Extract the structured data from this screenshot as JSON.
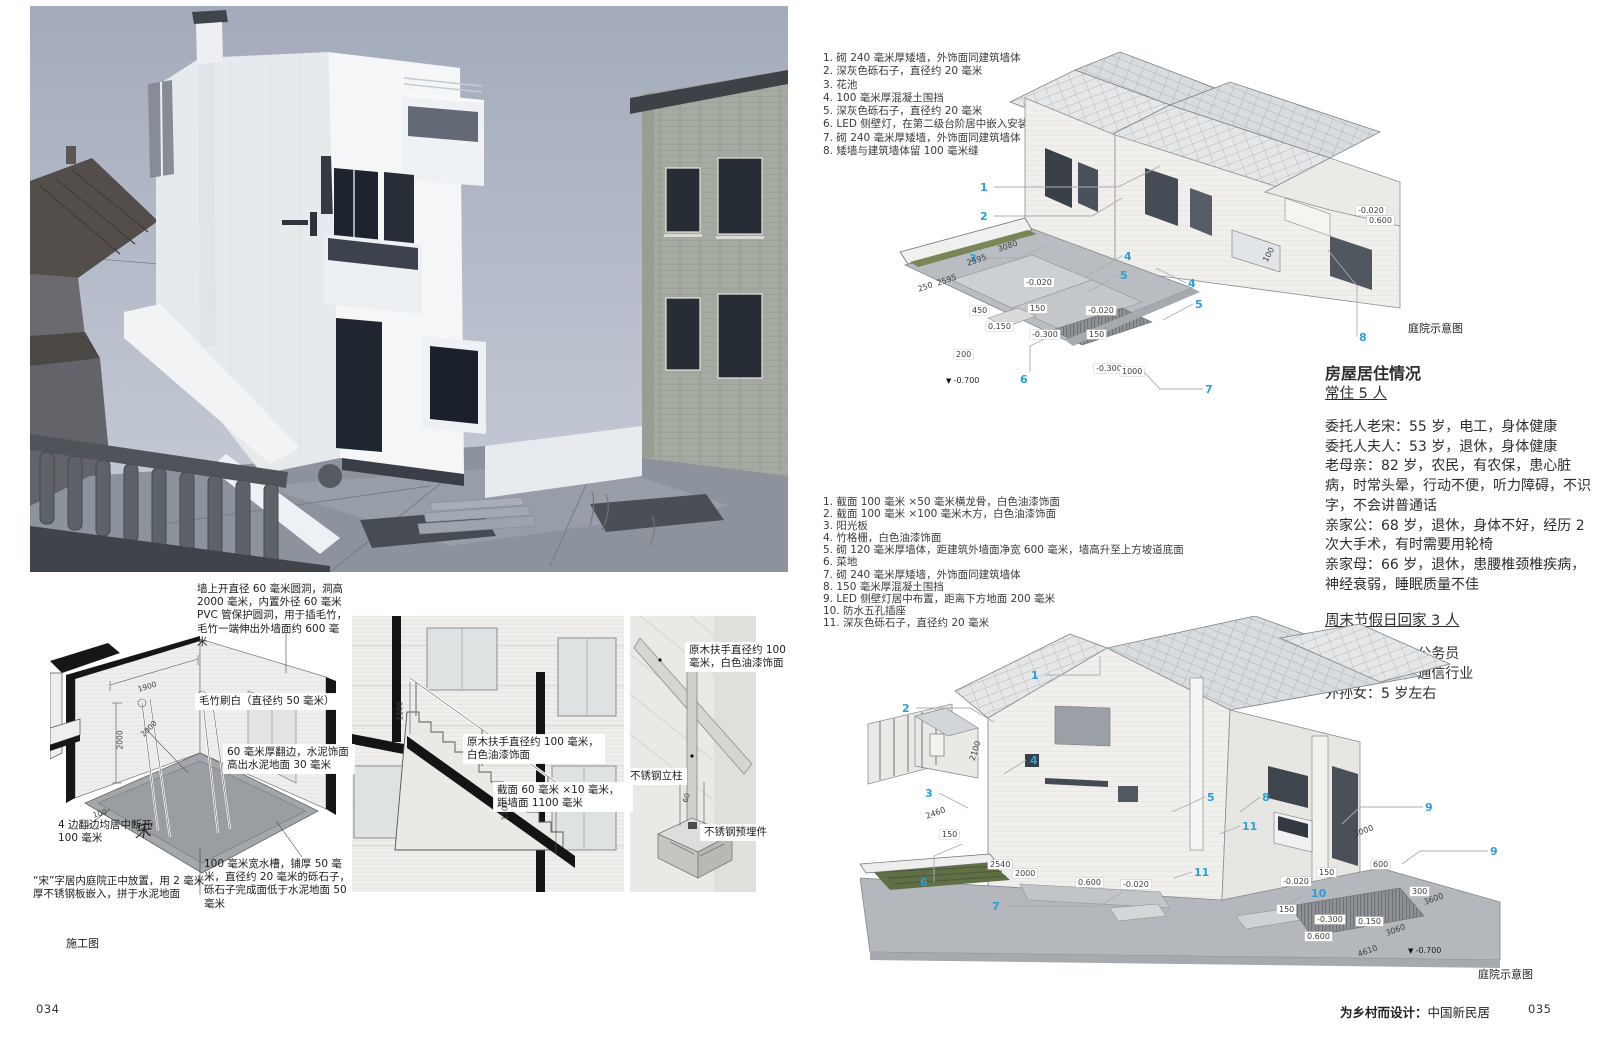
{
  "colors": {
    "callout_blue": "#2b9fd9",
    "accent_green": "#7a8657"
  },
  "meta": {
    "page_left_number": "034",
    "page_right_number": "035",
    "footer_title_bold": "为乡村而设计：",
    "footer_title_regular": "中国新民居"
  },
  "left_page": {
    "construction_caption": "施工图",
    "diagram_courtyard": {
      "note_top": "墙上开直径 60 毫米圆洞，洞高 2000 毫米，内置外径 60 毫米 PVC 管保护圆洞，用于插毛竹，毛竹一端伸出外墙面约 600 毫米",
      "label_bamboo": "毛竹刷白（直径约 50 毫米）",
      "label_edge": "60 毫米厚翻边，水泥饰面高出水泥地面 30 毫米",
      "label_gap": "4 边翻边均居中断开 100 毫米",
      "label_song": "“宋”字居内庭院正中放置，用 2 毫米厚不锈钢板嵌入，拼于水泥地面",
      "label_trough": "100 毫米宽水槽，铺厚 50 毫米，直径约 20 毫米的砾石子，砾石子完成面低于水泥地面 50 毫米",
      "floor_character": "宋",
      "dims": [
        {
          "t": "1900",
          "x": 88,
          "y": 52,
          "r": -17
        },
        {
          "t": "2000",
          "x": 70,
          "y": 112,
          "r": -90
        },
        {
          "t": "2000",
          "x": 92,
          "y": 98,
          "r": -45
        },
        {
          "t": "100",
          "x": 43,
          "y": 178,
          "r": -17
        }
      ]
    },
    "diagram_stairs": {
      "label_handrail": "原木扶手直径约 100 毫米，白色油漆饰面",
      "label_section": "截面 60 毫米 ×10 毫米，距墙面 1100 毫米",
      "dims": [
        {
          "t": "1100",
          "x": 48,
          "y": 100,
          "r": -90
        },
        {
          "t": "1100",
          "x": 153,
          "y": 200,
          "r": -90
        }
      ]
    },
    "diagram_post": {
      "label_handrail": "原木扶手直径约 100 毫米，白色油漆饰面",
      "label_post": "不锈钢立柱",
      "label_embed": "不锈钢预埋件",
      "dims": [
        {
          "t": "60",
          "x": 55,
          "y": 182,
          "r": -75
        }
      ]
    }
  },
  "right_page": {
    "notes_upper": [
      "1.  砌 240 毫米厚矮墙，外饰面同建筑墙体",
      "2.  深灰色砾石子，直径约 20 毫米",
      "3.  花池",
      "4.  100 毫米厚混凝土围挡",
      "5.  深灰色砾石子，直径约 20 毫米",
      "6.  LED 侧壁灯，在第二级台阶居中嵌入安装",
      "7.  砌 240 毫米厚矮墙，外饰面同建筑墙体",
      "8.  矮墙与建筑墙体留 100 毫米缝"
    ],
    "notes_lower": [
      "1.  截面 100 毫米 ×50 毫米横龙骨，白色油漆饰面",
      "2.  截面 100 毫米 ×100 毫米木方，白色油漆饰面",
      "3.  阳光板",
      "4.  竹格栅，白色油漆饰面",
      "5.  砌 120 毫米厚墙体，距建筑外墙面净宽 600 毫米，墙高升至上方坡道底面",
      "6.  菜地",
      "7.  砌 240 毫米厚矮墙，外饰面同建筑墙体",
      "8.  150 毫米厚混凝土围挡",
      "9.  LED 侧壁灯居中布置，距离下方地面 200 毫米",
      "10. 防水五孔插座",
      "11. 深灰色砾石子，直径约 20 毫米"
    ],
    "occupancy": {
      "title": "房屋居住情况",
      "subhead_resident": "常住 5 人",
      "residents": [
        "委托人老宋：55 岁，电工，身体健康",
        "委托人夫人：53 岁，退休，身体健康",
        "老母亲：82 岁，农民，有农保，患心脏病，时常头晕，行动不便，听力障碍，不识字，不会讲普通话",
        "亲家公：68 岁，退休，身体不好，经历 2 次大手术，有时需要用轮椅",
        "亲家母：66 岁，退休，患腰椎颈椎疾病，神经衰弱，睡眠质量不佳"
      ],
      "subhead_weekend": "周末节假日回家 3 人",
      "weekend": [
        "女儿：31 岁，公务员",
        "女婿：36 岁，通信行业",
        "外孙女：5 岁左右"
      ]
    },
    "axon_upper": {
      "caption": "庭院示意图",
      "callouts": [
        {
          "t": "1",
          "x": 120,
          "y": 141
        },
        {
          "t": "2",
          "x": 120,
          "y": 170
        },
        {
          "t": "3",
          "x": 109,
          "y": 212
        },
        {
          "t": "4",
          "x": 264,
          "y": 210
        },
        {
          "t": "5",
          "x": 260,
          "y": 229
        },
        {
          "t": "4",
          "x": 328,
          "y": 237
        },
        {
          "t": "5",
          "x": 335,
          "y": 258
        },
        {
          "t": "6",
          "x": 160,
          "y": 333
        },
        {
          "t": "7",
          "x": 345,
          "y": 343
        },
        {
          "t": "8",
          "x": 499,
          "y": 291
        }
      ],
      "dims": [
        {
          "t": "3080",
          "x": 138,
          "y": 205,
          "r": -19,
          "k": "rot"
        },
        {
          "t": "2595",
          "x": 107,
          "y": 219,
          "r": -19,
          "k": "rot"
        },
        {
          "t": "2595",
          "x": 77,
          "y": 239,
          "r": -19,
          "k": "rot"
        },
        {
          "t": "250",
          "x": 58,
          "y": 245,
          "r": -19,
          "k": "rot"
        },
        {
          "t": "100",
          "x": 405,
          "y": 217,
          "r": -62,
          "k": "rot"
        },
        {
          "t": "-0.020",
          "x": 164,
          "y": 238,
          "k": "box"
        },
        {
          "t": "450",
          "x": 110,
          "y": 266,
          "k": "box"
        },
        {
          "t": "150",
          "x": 168,
          "y": 264,
          "k": "box"
        },
        {
          "t": "0.150",
          "x": 126,
          "y": 282,
          "k": "box"
        },
        {
          "t": "-0.300",
          "x": 170,
          "y": 290,
          "k": "box"
        },
        {
          "t": "-0.020",
          "x": 226,
          "y": 266,
          "k": "box"
        },
        {
          "t": "150",
          "x": 227,
          "y": 290,
          "k": "box"
        },
        {
          "t": "-0.300",
          "x": 234,
          "y": 324,
          "k": "box"
        },
        {
          "t": "1000",
          "x": 260,
          "y": 327,
          "k": "box"
        },
        {
          "t": "200",
          "x": 94,
          "y": 310,
          "k": "box"
        },
        {
          "t": "-0.020",
          "x": 496,
          "y": 166,
          "k": "box"
        },
        {
          "t": "0.600",
          "x": 507,
          "y": 176,
          "k": "box"
        },
        {
          "t": "-0.700",
          "x": 86,
          "y": 336,
          "k": "lvl"
        }
      ]
    },
    "axon_lower": {
      "caption": "庭院示意图",
      "callouts": [
        {
          "t": "1",
          "x": 171,
          "y": 53
        },
        {
          "t": "2",
          "x": 42,
          "y": 86
        },
        {
          "t": "3",
          "x": 65,
          "y": 171
        },
        {
          "t": "4",
          "x": 170,
          "y": 138
        },
        {
          "t": "5",
          "x": 347,
          "y": 175
        },
        {
          "t": "6",
          "x": 60,
          "y": 260
        },
        {
          "t": "7",
          "x": 132,
          "y": 284
        },
        {
          "t": "8",
          "x": 402,
          "y": 175
        },
        {
          "t": "9",
          "x": 565,
          "y": 185
        },
        {
          "t": "9",
          "x": 630,
          "y": 229
        },
        {
          "t": "10",
          "x": 451,
          "y": 271
        },
        {
          "t": "11",
          "x": 382,
          "y": 204
        },
        {
          "t": "11",
          "x": 334,
          "y": 250
        }
      ],
      "dims": [
        {
          "t": "2100",
          "x": 112,
          "y": 140,
          "r": -72,
          "k": "rot"
        },
        {
          "t": "2460",
          "x": 66,
          "y": 196,
          "r": -20,
          "k": "rot"
        },
        {
          "t": "3000",
          "x": 494,
          "y": 214,
          "r": -20,
          "k": "rot"
        },
        {
          "t": "3600",
          "x": 564,
          "y": 282,
          "r": -20,
          "k": "rot"
        },
        {
          "t": "3060",
          "x": 526,
          "y": 313,
          "r": -20,
          "k": "rot"
        },
        {
          "t": "4610",
          "x": 498,
          "y": 334,
          "r": -20,
          "k": "rot"
        },
        {
          "t": "150",
          "x": 80,
          "y": 214,
          "k": "box"
        },
        {
          "t": "2540",
          "x": 128,
          "y": 244,
          "k": "box"
        },
        {
          "t": "2000",
          "x": 153,
          "y": 253,
          "k": "box"
        },
        {
          "t": "0.600",
          "x": 216,
          "y": 262,
          "k": "box"
        },
        {
          "t": "-0.020",
          "x": 261,
          "y": 264,
          "k": "box"
        },
        {
          "t": "600",
          "x": 511,
          "y": 244,
          "k": "box"
        },
        {
          "t": "300",
          "x": 550,
          "y": 271,
          "k": "box"
        },
        {
          "t": "150",
          "x": 457,
          "y": 252,
          "k": "box"
        },
        {
          "t": "-0.020",
          "x": 421,
          "y": 261,
          "k": "box"
        },
        {
          "t": "150",
          "x": 417,
          "y": 289,
          "k": "box"
        },
        {
          "t": "-0.300",
          "x": 455,
          "y": 299,
          "k": "box"
        },
        {
          "t": "0.150",
          "x": 496,
          "y": 301,
          "k": "box"
        },
        {
          "t": "0.600",
          "x": 445,
          "y": 316,
          "k": "box"
        },
        {
          "t": "-0.700",
          "x": 548,
          "y": 330,
          "k": "lvl"
        }
      ]
    }
  }
}
